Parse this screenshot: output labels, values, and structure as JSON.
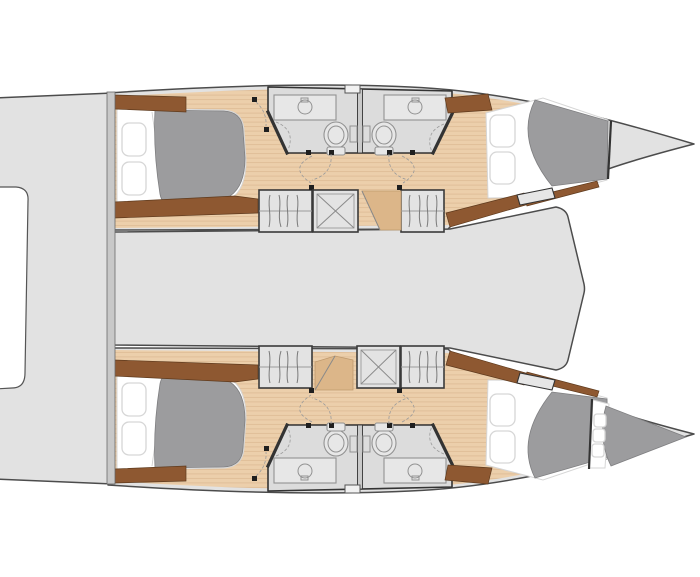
{
  "meta": {
    "title": "catamaran-4-cabin-layout-plan",
    "view": "top-down-deck-plan"
  },
  "palette": {
    "background": "#ffffff",
    "deck": "#e2e2e2",
    "outline": "#4c4c4c",
    "wood_base": "#eccfab",
    "wood_stripe": "#dfbd97",
    "wood_dark": "#dcb689",
    "brown": "#8e5831",
    "brown_stroke": "#5e3a1d",
    "duvet": "#9c9c9e",
    "duvet_stroke": "#7f7f81",
    "mattress": "#ffffff",
    "mattress_stroke": "#d6d6d6",
    "bath": "#dcdcdc",
    "wall": "#333333",
    "fixture": "#929292",
    "cabinet": "#e3e3e3",
    "innerline": "#9b9b9b",
    "strip": "#c8c8c8",
    "swing": "#9a9a9a",
    "post": "#1f1f1f",
    "step_fill": "#e6e6e6"
  },
  "elements": {
    "hull_count": 2,
    "cabins": [
      "port-aft-cabin",
      "port-forward-cabin",
      "starboard-aft-cabin",
      "starboard-forward-cabin"
    ],
    "heads": [
      "port-aft-head",
      "port-forward-head",
      "starboard-aft-head",
      "starboard-forward-head"
    ],
    "wardrobe_count": 4,
    "companionway_hatch_count": 2,
    "forepeak_berth_hull": "starboard",
    "features": [
      "double-berth",
      "pillows",
      "duvet",
      "sink-counter",
      "toilet",
      "shower-curtain",
      "hanging-locker",
      "companionway-steps",
      "stern-platform",
      "stern-notch",
      "bow-point"
    ]
  }
}
